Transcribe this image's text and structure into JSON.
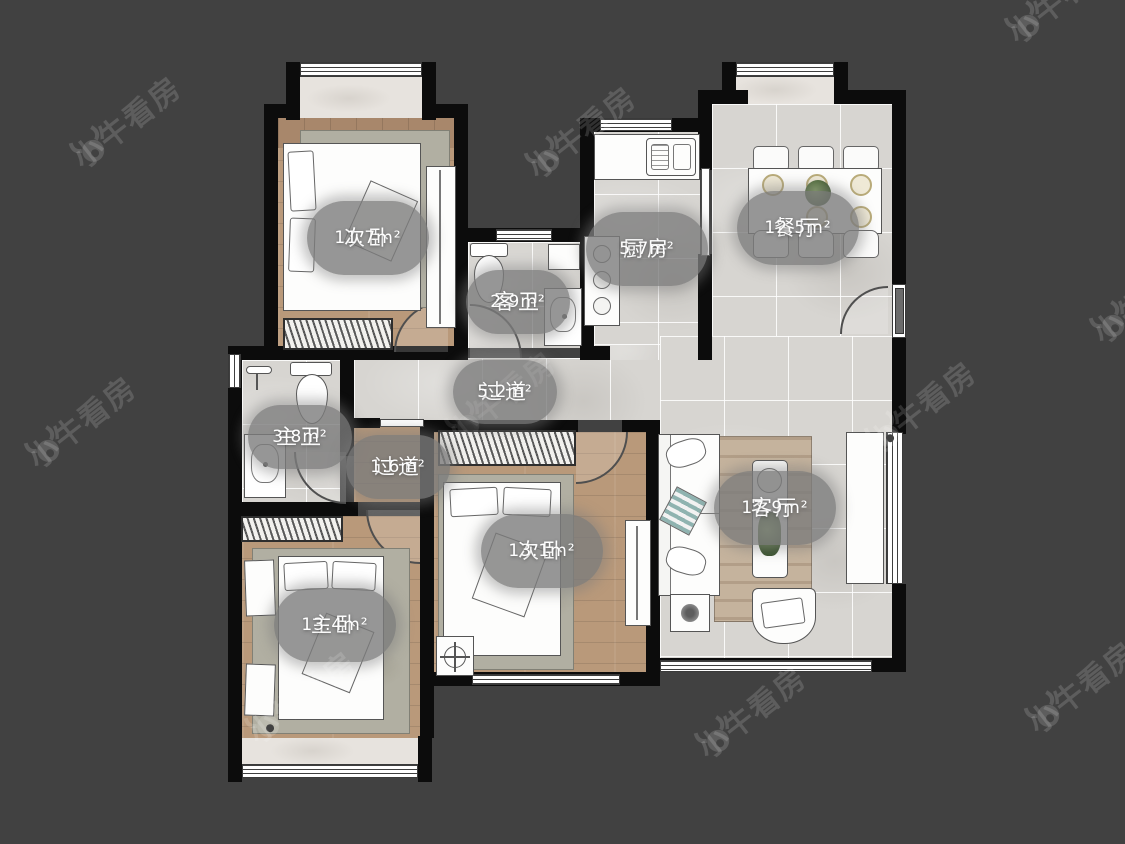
{
  "watermark": {
    "brand": "小牛看房"
  },
  "rooms": [
    {
      "id": "bedroom-top",
      "name": "次卧",
      "area": "11.7m²"
    },
    {
      "id": "guest-bath",
      "name": "客卫",
      "area": "2.9m²"
    },
    {
      "id": "kitchen",
      "name": "厨房",
      "area": "5.7m²"
    },
    {
      "id": "dining",
      "name": "餐厅",
      "area": "12.5m²"
    },
    {
      "id": "hallway",
      "name": "过道",
      "area": "5.2m²"
    },
    {
      "id": "master-bath",
      "name": "主卫",
      "area": "3.8m²"
    },
    {
      "id": "hallway-small",
      "name": "过道",
      "area": "1.6m²"
    },
    {
      "id": "living",
      "name": "客厅",
      "area": "17.9m²"
    },
    {
      "id": "bedroom-mid",
      "name": "次卧",
      "area": "13.1m²"
    },
    {
      "id": "master-bedroom",
      "name": "主卧",
      "area": "13.4m²"
    }
  ]
}
